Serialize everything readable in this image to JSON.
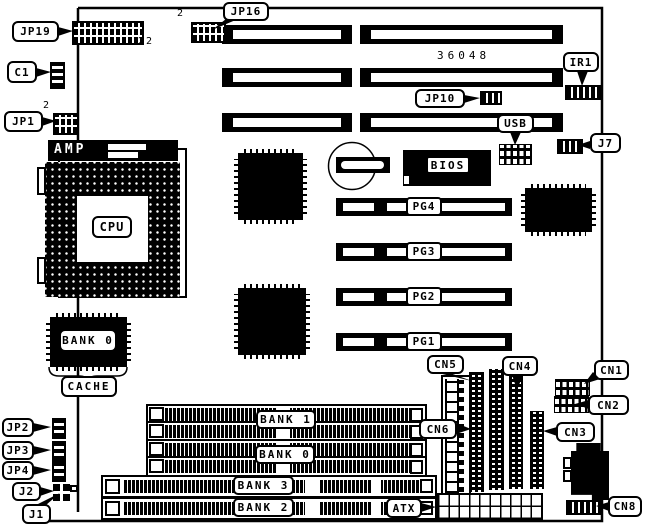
{
  "board": {
    "part_number": "36048"
  },
  "callouts": {
    "jp19": "JP19",
    "jp19_pin_count": "22",
    "c1": "C1",
    "jp1": "JP1",
    "jp1_pin": "2",
    "jp16": "JP16",
    "jp16_pin": "2",
    "jp10": "JP10",
    "ir1": "IR1",
    "usb": "USB",
    "j7": "J7",
    "jp2": "JP2",
    "jp3": "JP3",
    "jp4": "JP4",
    "j2": "J2",
    "j1": "J1",
    "cn1": "CN1",
    "cn2": "CN2",
    "cn3": "CN3",
    "cn4": "CN4",
    "cn5": "CN5",
    "cn6": "CN6",
    "cn8": "CN8",
    "atx": "ATX"
  },
  "chips": {
    "cpu": "CPU",
    "cpu_bracket": "AMP",
    "bios": "BIOS",
    "cache_bank": "BANK 0",
    "cache": "CACHE"
  },
  "slots": {
    "pci": [
      "PG4",
      "PG3",
      "PG2",
      "PG1"
    ],
    "simm_banks": [
      "BANK 1",
      "BANK 0"
    ],
    "dimm_banks": [
      "BANK 3",
      "BANK 2"
    ]
  }
}
